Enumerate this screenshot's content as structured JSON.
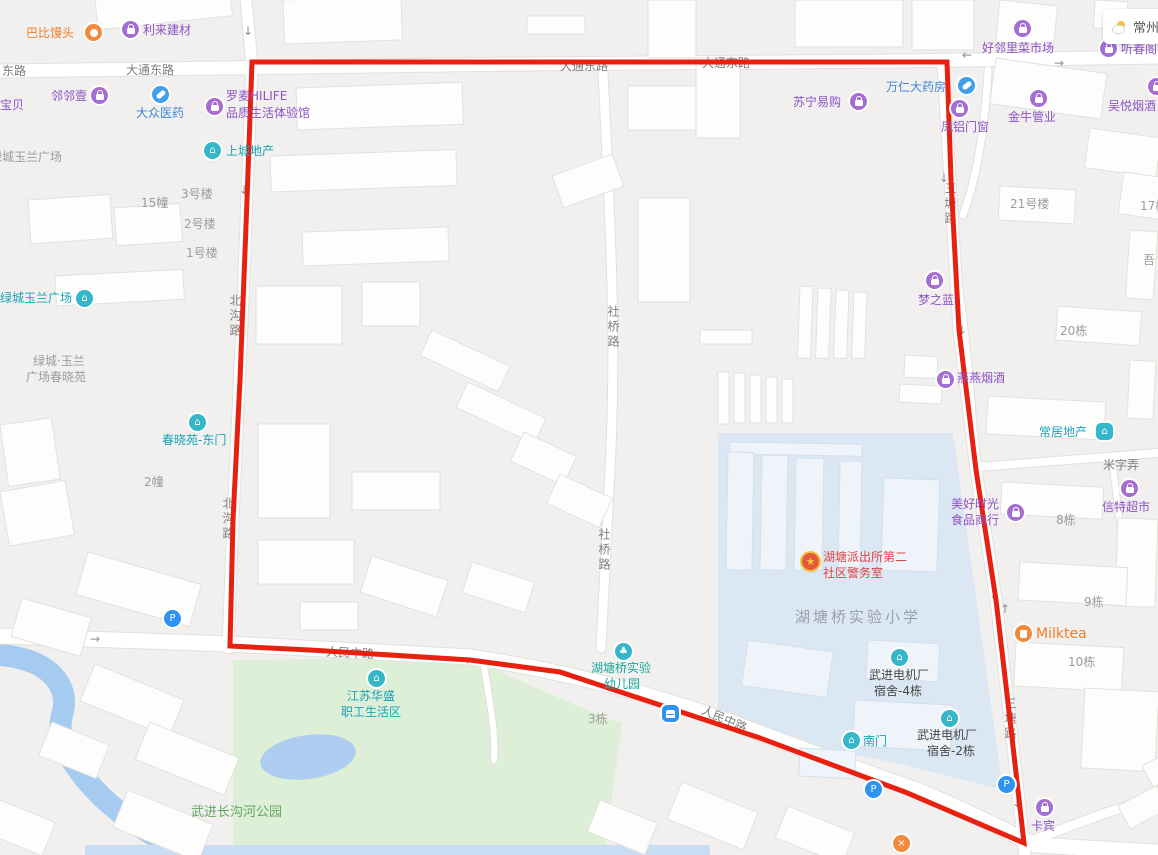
{
  "app": {
    "type": "map-view"
  },
  "weather": {
    "city": "常州"
  },
  "colors": {
    "red_boundary": "#e8200f",
    "road_label": "#7e7e7e",
    "poi_purple": "#8d52c6",
    "poi_blue": "#3f85d6",
    "poi_teal": "#17a3b8",
    "poi_orange": "#ef7e28",
    "police_text": "#e24343",
    "park_green": "#ddefd6",
    "campus_blue": "#dbe8f4",
    "water_blue": "#a6cbf0"
  },
  "glyphs": {
    "down": "↓",
    "up": "↑",
    "left": "←",
    "right": "→",
    "p": "P",
    "star": "★",
    "tree": "♣",
    "house": "⌂",
    "x": "×"
  },
  "roads": {
    "donglu": "东路",
    "datong": "大通东路",
    "beigou": "北沟路",
    "sheqiao": "社桥路",
    "santang": "三塘路",
    "renmin": "人民中路",
    "mizilong": "米字弄"
  },
  "places": {
    "lvcheng_plaza_gray": "绿城玉兰广场",
    "b15": "15幢",
    "b3h": "3号楼",
    "b2h": "2号楼",
    "b1h": "1号楼",
    "lvcheng_l1": "绿城·玉兰",
    "lvcheng_l2": "广场春晓苑",
    "b2z": "2幢",
    "b3d": "3栋",
    "b21h": "21号楼",
    "b17d": "17栋",
    "wu": "吾",
    "b20d": "20栋",
    "b8d": "8栋",
    "b9d": "9栋",
    "b10d": "10栋",
    "school": "湖塘桥实验小学",
    "park": "武进长沟河公园"
  },
  "pois": {
    "babimantou": {
      "name": "巴比馒头"
    },
    "lilai": {
      "name": "利来建材"
    },
    "linlinyi": {
      "name": "邻邻壹"
    },
    "baobei": {
      "name": "宝贝"
    },
    "dazhong": {
      "name": "大众医药"
    },
    "luomai": {
      "l1": "罗麦HILIFE",
      "l2": "品质生活体验馆"
    },
    "shangcheng": {
      "name": "上城地产"
    },
    "lvcheng_poi": {
      "name": "绿城玉兰广场"
    },
    "chunxiao_gate": {
      "name": "春晓苑-东门"
    },
    "kindergarten": {
      "l1": "湖塘桥实验",
      "l2": "幼儿园"
    },
    "huasheng": {
      "l1": "江苏华盛",
      "l2": "职工生活区"
    },
    "police": {
      "l1": "湖塘派出所第二",
      "l2": "社区警务室"
    },
    "dorm4": {
      "l1": "武进电机厂",
      "l2": "宿舍-4栋"
    },
    "south_gate": {
      "name": "南门"
    },
    "dorm2": {
      "l1": "武进电机厂",
      "l2": "宿舍-2栋"
    },
    "kabin": {
      "name": "卡宾"
    },
    "suning": {
      "name": "苏宁易购"
    },
    "wanren": {
      "name": "万仁大药房"
    },
    "fenglv": {
      "name": "凤铝门窗"
    },
    "haolinli": {
      "name": "好邻里菜市场"
    },
    "jinniu": {
      "name": "金牛管业"
    },
    "wuyue": {
      "name": "吴悦烟酒"
    },
    "tingchun": {
      "name": "听春阁"
    },
    "mengzhilan": {
      "name": "梦之蓝"
    },
    "yanyan": {
      "name": "燕燕烟酒"
    },
    "changju": {
      "name": "常居地产"
    },
    "xinte": {
      "name": "信特超市"
    },
    "meihao": {
      "l1": "美好时光",
      "l2": "食品商行"
    },
    "milktea": {
      "name": "Milktea"
    }
  }
}
